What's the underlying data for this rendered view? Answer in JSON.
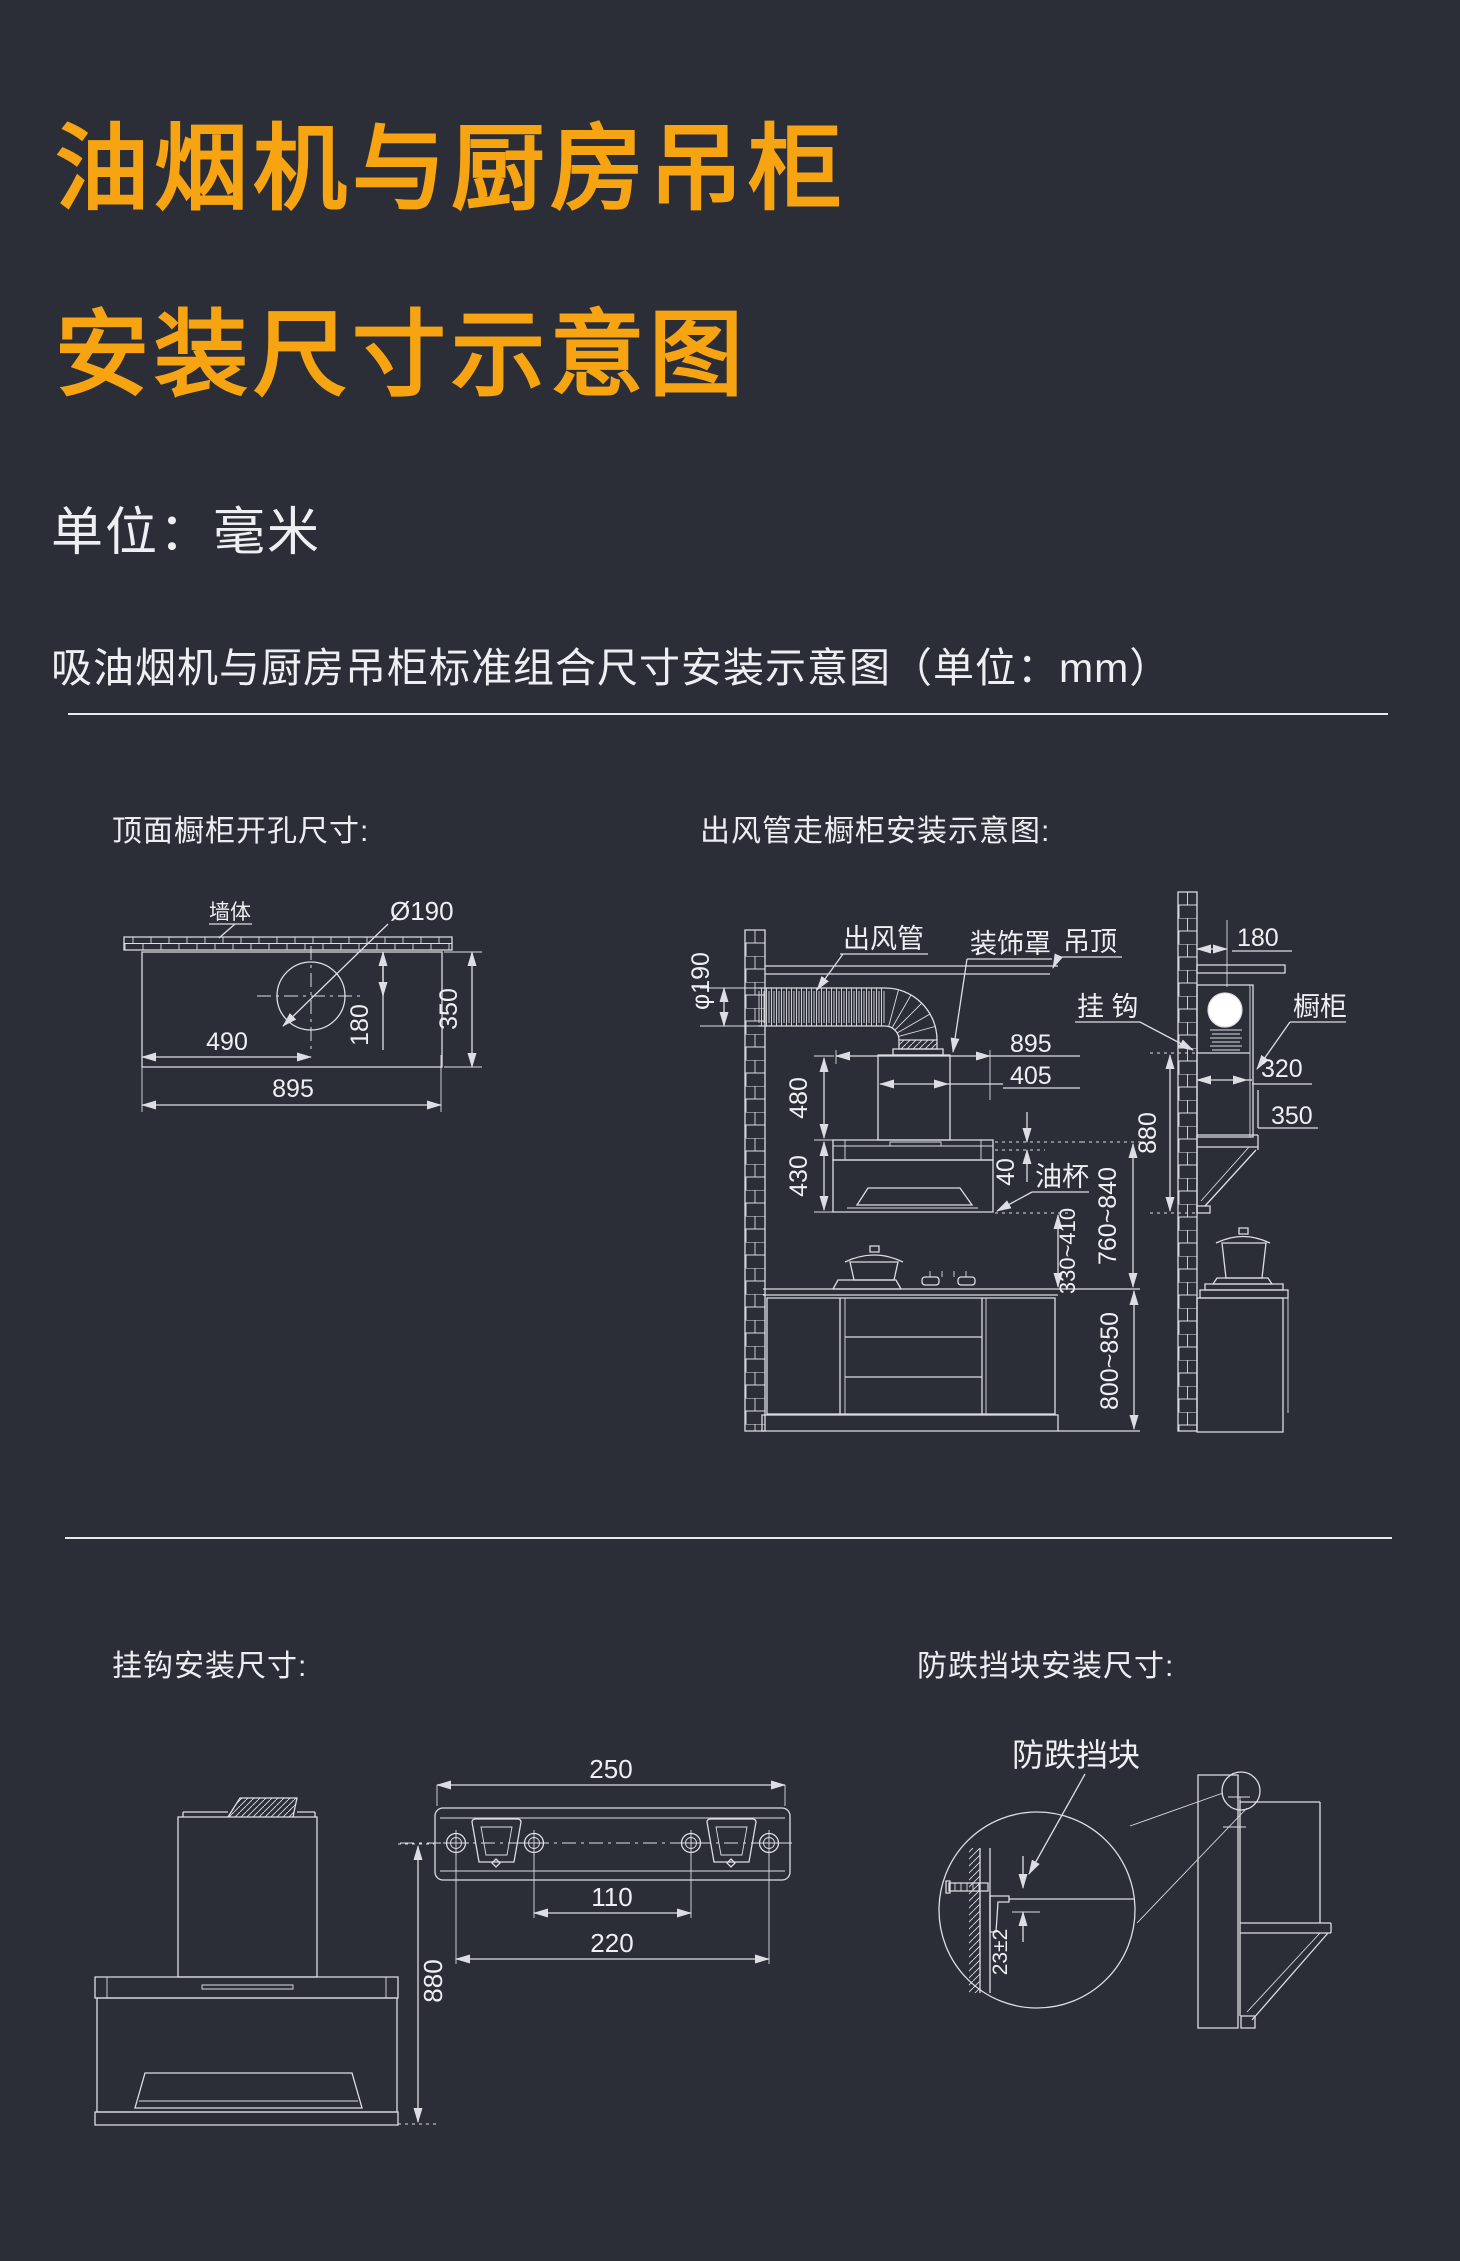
{
  "page": {
    "colors": {
      "background": "#2b2d37",
      "accent": "#f7a413",
      "ink": "#edeff2",
      "line": "#dcdee3"
    }
  },
  "header": {
    "title_line1": "油烟机与厨房吊柜",
    "title_line2": "安装尺寸示意图",
    "unit_label": "单位：毫米",
    "subtitle": "吸油烟机与厨房吊柜标准组合尺寸安装示意图（单位：mm）"
  },
  "top_left": {
    "title": "顶面橱柜开孔尺寸:",
    "labels": {
      "wall": "墙体",
      "hole_diameter": "Ø190"
    },
    "dims": {
      "hole_offset_x": "490",
      "hole_offset_y": "180",
      "depth": "350",
      "width": "895"
    }
  },
  "top_right": {
    "title": "出风管走橱柜安装示意图:",
    "labels": {
      "duct": "出风管",
      "cover": "装饰罩",
      "ceiling": "吊顶",
      "hook": "挂 钩",
      "cabinet": "橱柜",
      "oil_cup": "油杯",
      "duct_diameter": "φ190"
    },
    "dims": {
      "hood_width": "895",
      "cover_width": "405",
      "cover_height": "480",
      "hood_height": "430",
      "rim_gap": "40",
      "wall_offset": "180",
      "cabinet_depth": "320",
      "cabinet_clearance": "350",
      "hang_height": "880",
      "hood_to_counter": "330~410",
      "hood_bottom_height": "760~840",
      "counter_height": "800~850"
    }
  },
  "bottom_left": {
    "title": "挂钩安装尺寸:",
    "dims": {
      "plate_width": "250",
      "inner_holes": "110",
      "outer_holes": "220",
      "hang_height": "880"
    }
  },
  "bottom_right": {
    "title": "防跌挡块安装尺寸:",
    "labels": {
      "block": "防跌挡块"
    },
    "dims": {
      "block_offset": "23±2"
    }
  }
}
